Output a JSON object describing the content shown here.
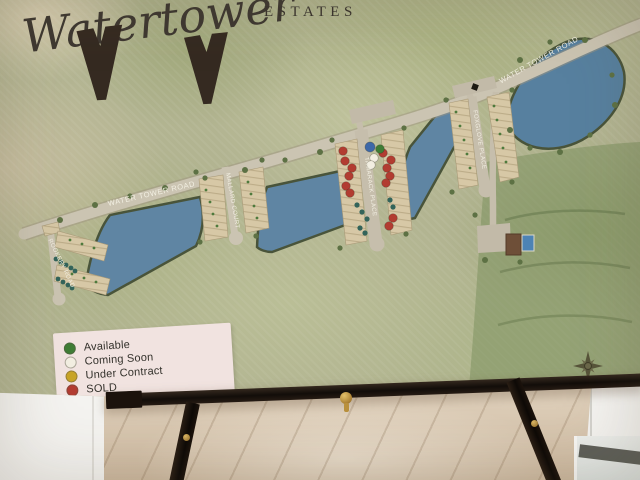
{
  "poster": {
    "title": {
      "script": "Watertower",
      "caps": "ESTATES"
    },
    "road_labels": [
      {
        "text": "WATER TOWER ROAD"
      },
      {
        "text": "WATER TOWER ROAD"
      }
    ],
    "street_labels": [
      {
        "text": "ROOKERY ROAD"
      },
      {
        "text": "MALLARD COURT"
      },
      {
        "text": "TAMARACK PLACE"
      },
      {
        "text": "FOXGLOVE PLACE"
      }
    ],
    "legend": {
      "items": [
        {
          "label": "Available",
          "status": "available"
        },
        {
          "label": "Coming Soon",
          "status": "coming_soon"
        },
        {
          "label": "Under Contract",
          "status": "under_contract"
        },
        {
          "label": "SOLD",
          "status": "sold"
        }
      ]
    },
    "status_colors": {
      "available": "#3f7d35",
      "coming_soon": "#f2eee1",
      "under_contract": "#c8a427",
      "sold": "#b23c31",
      "amenity": "#3d68a8"
    },
    "map_colors": {
      "pond": "#5f85a3",
      "road": "#cbc4b2",
      "lots": "#d7c8a6",
      "preserve": "#7e9161"
    },
    "lot_dots": [
      {
        "x": 343,
        "y": 151,
        "s": "sold"
      },
      {
        "x": 345,
        "y": 161,
        "s": "sold"
      },
      {
        "x": 352,
        "y": 168,
        "s": "sold"
      },
      {
        "x": 349,
        "y": 176,
        "s": "sold"
      },
      {
        "x": 346,
        "y": 186,
        "s": "sold"
      },
      {
        "x": 350,
        "y": 193,
        "s": "sold"
      },
      {
        "x": 383,
        "y": 153,
        "s": "sold"
      },
      {
        "x": 391,
        "y": 160,
        "s": "sold"
      },
      {
        "x": 387,
        "y": 168,
        "s": "sold"
      },
      {
        "x": 390,
        "y": 176,
        "s": "sold"
      },
      {
        "x": 386,
        "y": 183,
        "s": "sold"
      },
      {
        "x": 393,
        "y": 218,
        "s": "sold"
      },
      {
        "x": 389,
        "y": 226,
        "s": "sold"
      },
      {
        "x": 380,
        "y": 149,
        "s": "available"
      },
      {
        "x": 374,
        "y": 158,
        "s": "coming_soon"
      },
      {
        "x": 371,
        "y": 165,
        "s": "coming_soon"
      },
      {
        "x": 370,
        "y": 147,
        "s": "amenity",
        "r": 5
      }
    ]
  }
}
